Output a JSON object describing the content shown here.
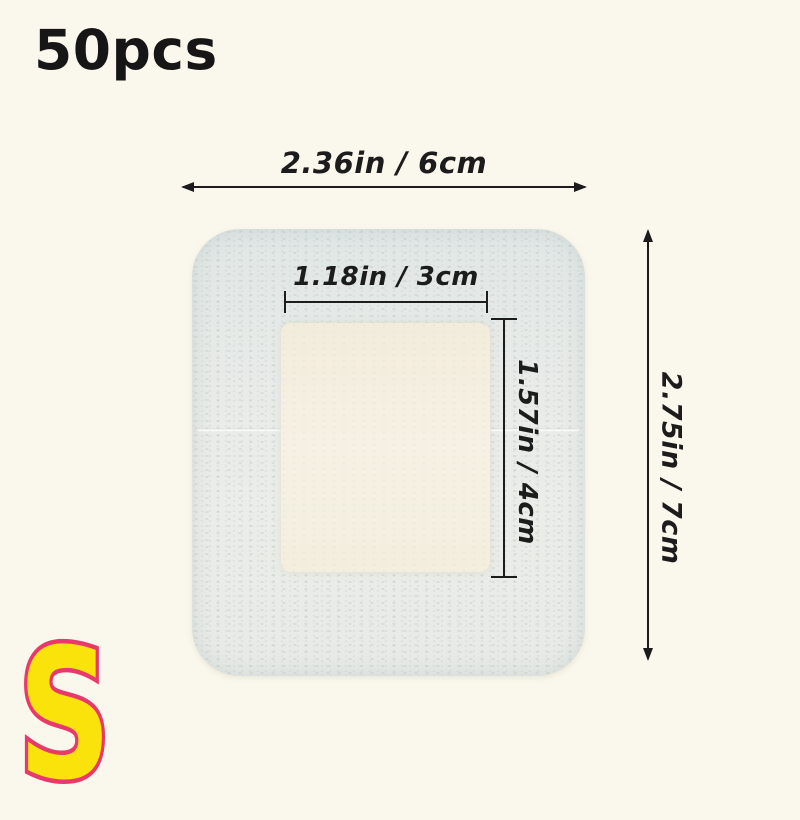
{
  "header": {
    "quantity": "50pcs"
  },
  "product": {
    "type": "adhesive-wound-dressing",
    "fabric_color": "#e8ebe8",
    "pad_color": "#f3efe2"
  },
  "dimensions": {
    "outer_width": "2.36in / 6cm",
    "pad_width": "1.18in / 3cm",
    "pad_height": "1.57in / 4cm",
    "outer_height": "2.75in / 7cm"
  },
  "badge": {
    "size": "S",
    "fill_color": "#f9e30b",
    "outline_color": "#e9386c"
  },
  "colors": {
    "background": "#faf7ec",
    "annotation_ink": "#1c1c1c"
  }
}
